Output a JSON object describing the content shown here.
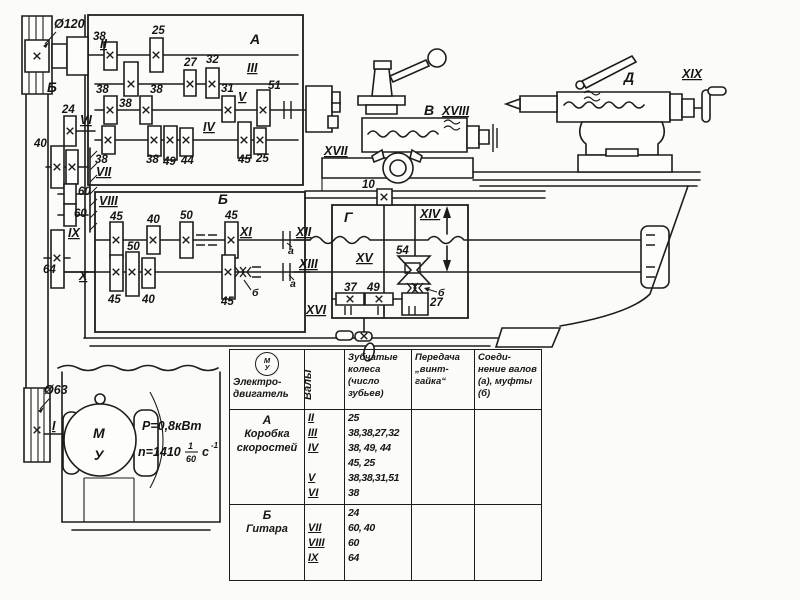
{
  "diagram": {
    "dims": {
      "pulley_big": "Ø120",
      "pulley_small": "Ø63"
    },
    "motor": {
      "letter_top": "М",
      "letter_bottom": "У",
      "power": "P=0,8кВт",
      "n_prefix": "n=1410",
      "n_num": "1",
      "n_den": "60",
      "n_unit": "с",
      "n_sup": "-1"
    },
    "sections": {
      "a": "А",
      "b": "Б",
      "b_guitar": "Б",
      "v": "В",
      "g": "Г",
      "d": "Д"
    },
    "shafts": {
      "i": "I",
      "ii": "II",
      "iii": "III",
      "iv": "IV",
      "v": "V",
      "vi": "VI",
      "vii": "VII",
      "viii": "VIII",
      "ix": "IX",
      "x": "X",
      "xi": "XI",
      "xii": "XII",
      "xiii": "XIII",
      "xiv": "XIV",
      "xv": "XV",
      "xvi": "XVI",
      "xvii": "XVII",
      "xviii": "XVIII",
      "xix": "XIX"
    },
    "gears": {
      "g10": "10",
      "g24": "24",
      "g25": "25",
      "g27": "27",
      "g31": "31",
      "g32": "32",
      "g37": "37",
      "g38": "38",
      "g40": "40",
      "g44": "44",
      "g45": "45",
      "g49": "49",
      "g50": "50",
      "g51": "51",
      "g54": "54",
      "g60": "60",
      "g64": "64"
    },
    "couplings": {
      "a": "а",
      "b": "б"
    }
  },
  "table": {
    "headers": {
      "motor_symbol_top": "М",
      "motor_symbol_bottom": "У",
      "col1_line1": "Электро-",
      "col1_line2": "двигатель",
      "col2": "Валы",
      "col3": "Зубчатые колеса (число зубьев)",
      "col4": "Передача „винт-гайка“",
      "col5": "Соеди-нение валов (а), муфты (б)"
    },
    "rows": [
      {
        "group": "А",
        "name_line1": "Коробка",
        "name_line2": "скоростей",
        "lines": [
          {
            "shaft": "II",
            "gears": "25"
          },
          {
            "shaft": "III",
            "gears": "38,38,27,32"
          },
          {
            "shaft": "IV",
            "gears": "38, 49, 44"
          },
          {
            "shaft": "",
            "gears": "45, 25"
          },
          {
            "shaft": "V",
            "gears": "38,38,31,51"
          },
          {
            "shaft": "VI",
            "gears": "38"
          }
        ]
      },
      {
        "group": "Б",
        "name_line1": "Гитара",
        "name_line2": "",
        "lines": [
          {
            "shaft": "",
            "gears": "24"
          },
          {
            "shaft": "VII",
            "gears": "60, 40"
          },
          {
            "shaft": "VIII",
            "gears": "60"
          },
          {
            "shaft": "IX",
            "gears": "64"
          }
        ]
      }
    ]
  }
}
